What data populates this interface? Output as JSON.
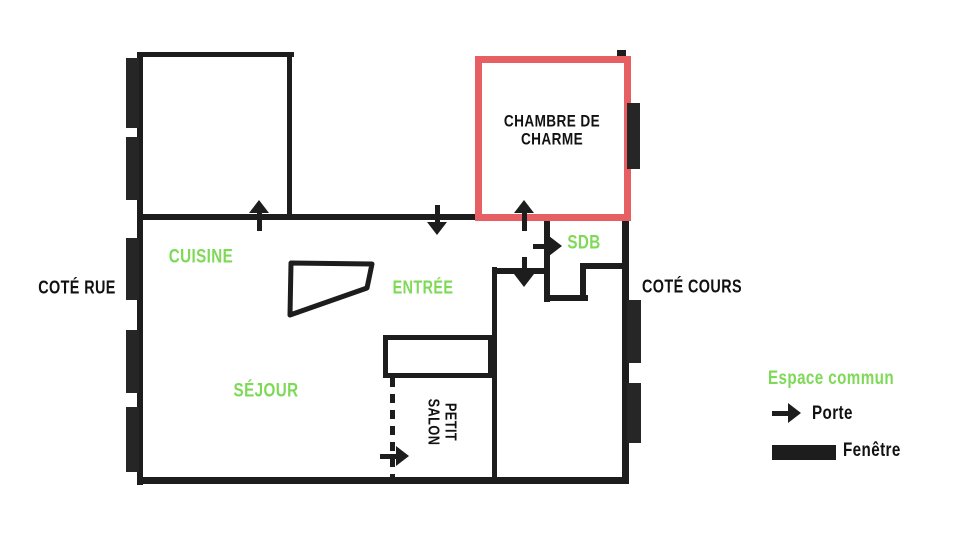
{
  "title": "Plan appartement",
  "colors": {
    "accent_green": "#7ed957",
    "highlight_red": "#e55f63",
    "wall_black": "#1d1d1d"
  },
  "rooms": {
    "chambre": "CHAMBRE DE\nCHARME",
    "cuisine": "CUISINE",
    "entree": "ENTRÉE",
    "sdb": "SDB",
    "sejour": "SÉJOUR",
    "petit_salon": "PETIT\nSALON"
  },
  "sides": {
    "left": "COTÉ RUE",
    "right": "COTÉ COURS"
  },
  "legend": {
    "espace_commun": "Espace commun",
    "porte": "Porte",
    "fenetre": "Fenêtre"
  },
  "icons": {
    "door": "arrow",
    "window": "black-block"
  }
}
